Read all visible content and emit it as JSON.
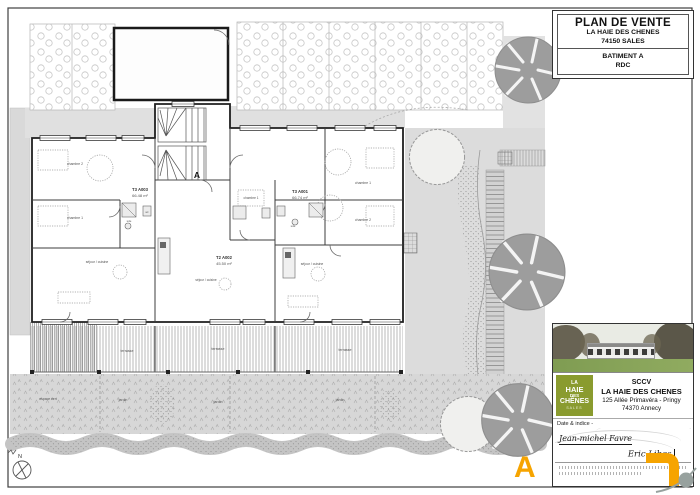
{
  "title_block": {
    "title": "PLAN DE VENTE",
    "project": "LA HAIE DES CHENES",
    "city": "74150 SALES",
    "building": "BATIMENT A",
    "level": "RDC"
  },
  "plan": {
    "marker": "A",
    "north": "N",
    "apartments": [
      {
        "id": "T3 A003",
        "area": "66.48 m²"
      },
      {
        "id": "T2 A002",
        "area": "45.50 m²"
      },
      {
        "id": "T3 A001",
        "area": "66.74 m²"
      }
    ],
    "rooms": {
      "chambre1": "chambre 1",
      "chambre2": "chambre 2",
      "sejour": "séjour / cuisine",
      "sde": "sde",
      "wc": "wc",
      "terrasse": "terrasse",
      "jardin": "jardin",
      "espace_vert": "espace vert"
    }
  },
  "info_block": {
    "logo": {
      "line1": "LA",
      "line2": "HAIE",
      "line3": "DES",
      "line4": "CHÊNES",
      "sub": "SALES"
    },
    "company": "SCCV",
    "name": "LA HAIE DES CHENES",
    "address1": "125 Allée Primavéra - Pringy",
    "address2": "74370 Annecy",
    "date_label": "Date & indice -",
    "signature1": "Jean-michel Favre",
    "signature2": "Eric Libes"
  },
  "sheet_marker": "A",
  "colors": {
    "accent_orange": "#F6A400",
    "logo_green": "#8A9B2F"
  }
}
